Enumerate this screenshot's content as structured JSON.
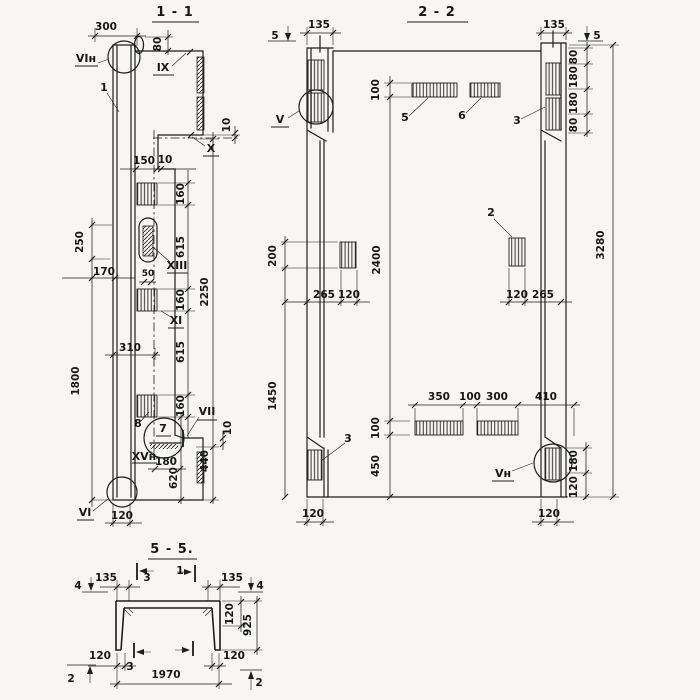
{
  "meta": {
    "paper_color": "#f7f6f2",
    "ink_color": "#1d1d1d",
    "drawing_type": "structural-panel-sections"
  },
  "s11": {
    "title": "1 - 1",
    "labels": {
      "vin": "VIн",
      "n1": "1",
      "ix": "IX",
      "x": "X",
      "xiii": "XIII",
      "xi": "XI",
      "n8": "8",
      "n7": "7",
      "vii": "VII",
      "xvn": "XVн",
      "vi": "VI"
    },
    "dims": {
      "w300": "300",
      "h80": "80",
      "t10": "10",
      "w150": "150",
      "w10": "10",
      "c160": "160",
      "c615": "615",
      "c2250": "2250",
      "l250": "250",
      "l1800": "1800",
      "l170": "170",
      "l50": "50",
      "l310": "310",
      "b180": "180",
      "b620": "620",
      "b440": "440",
      "b120": "120",
      "b10": "10"
    }
  },
  "s22": {
    "title": "2 - 2",
    "cut": "5",
    "labels": {
      "v": "V",
      "vn": "Vн",
      "n2": "2",
      "n3": "3",
      "n5": "5",
      "n6": "6"
    },
    "dims": {
      "w135": "135",
      "h80": "80",
      "h180": "180",
      "v3280": "3280",
      "t100": "100",
      "v2400": "2400",
      "b100": "100",
      "b450": "450",
      "l200": "200",
      "l1450": "1450",
      "a265": "265",
      "a120": "120",
      "b350": "350",
      "g100": "100",
      "b300": "300",
      "b410": "410",
      "r180": "180",
      "r120": "120",
      "bl120": "120",
      "br120": "120"
    }
  },
  "s55": {
    "title": "5 - 5.",
    "marks": {
      "m4": "4",
      "m3": "3",
      "m1": "1",
      "m2": "2"
    },
    "dims": {
      "w135": "135",
      "f120": "120",
      "h925": "925",
      "e120": "120",
      "w1970": "1970"
    }
  }
}
